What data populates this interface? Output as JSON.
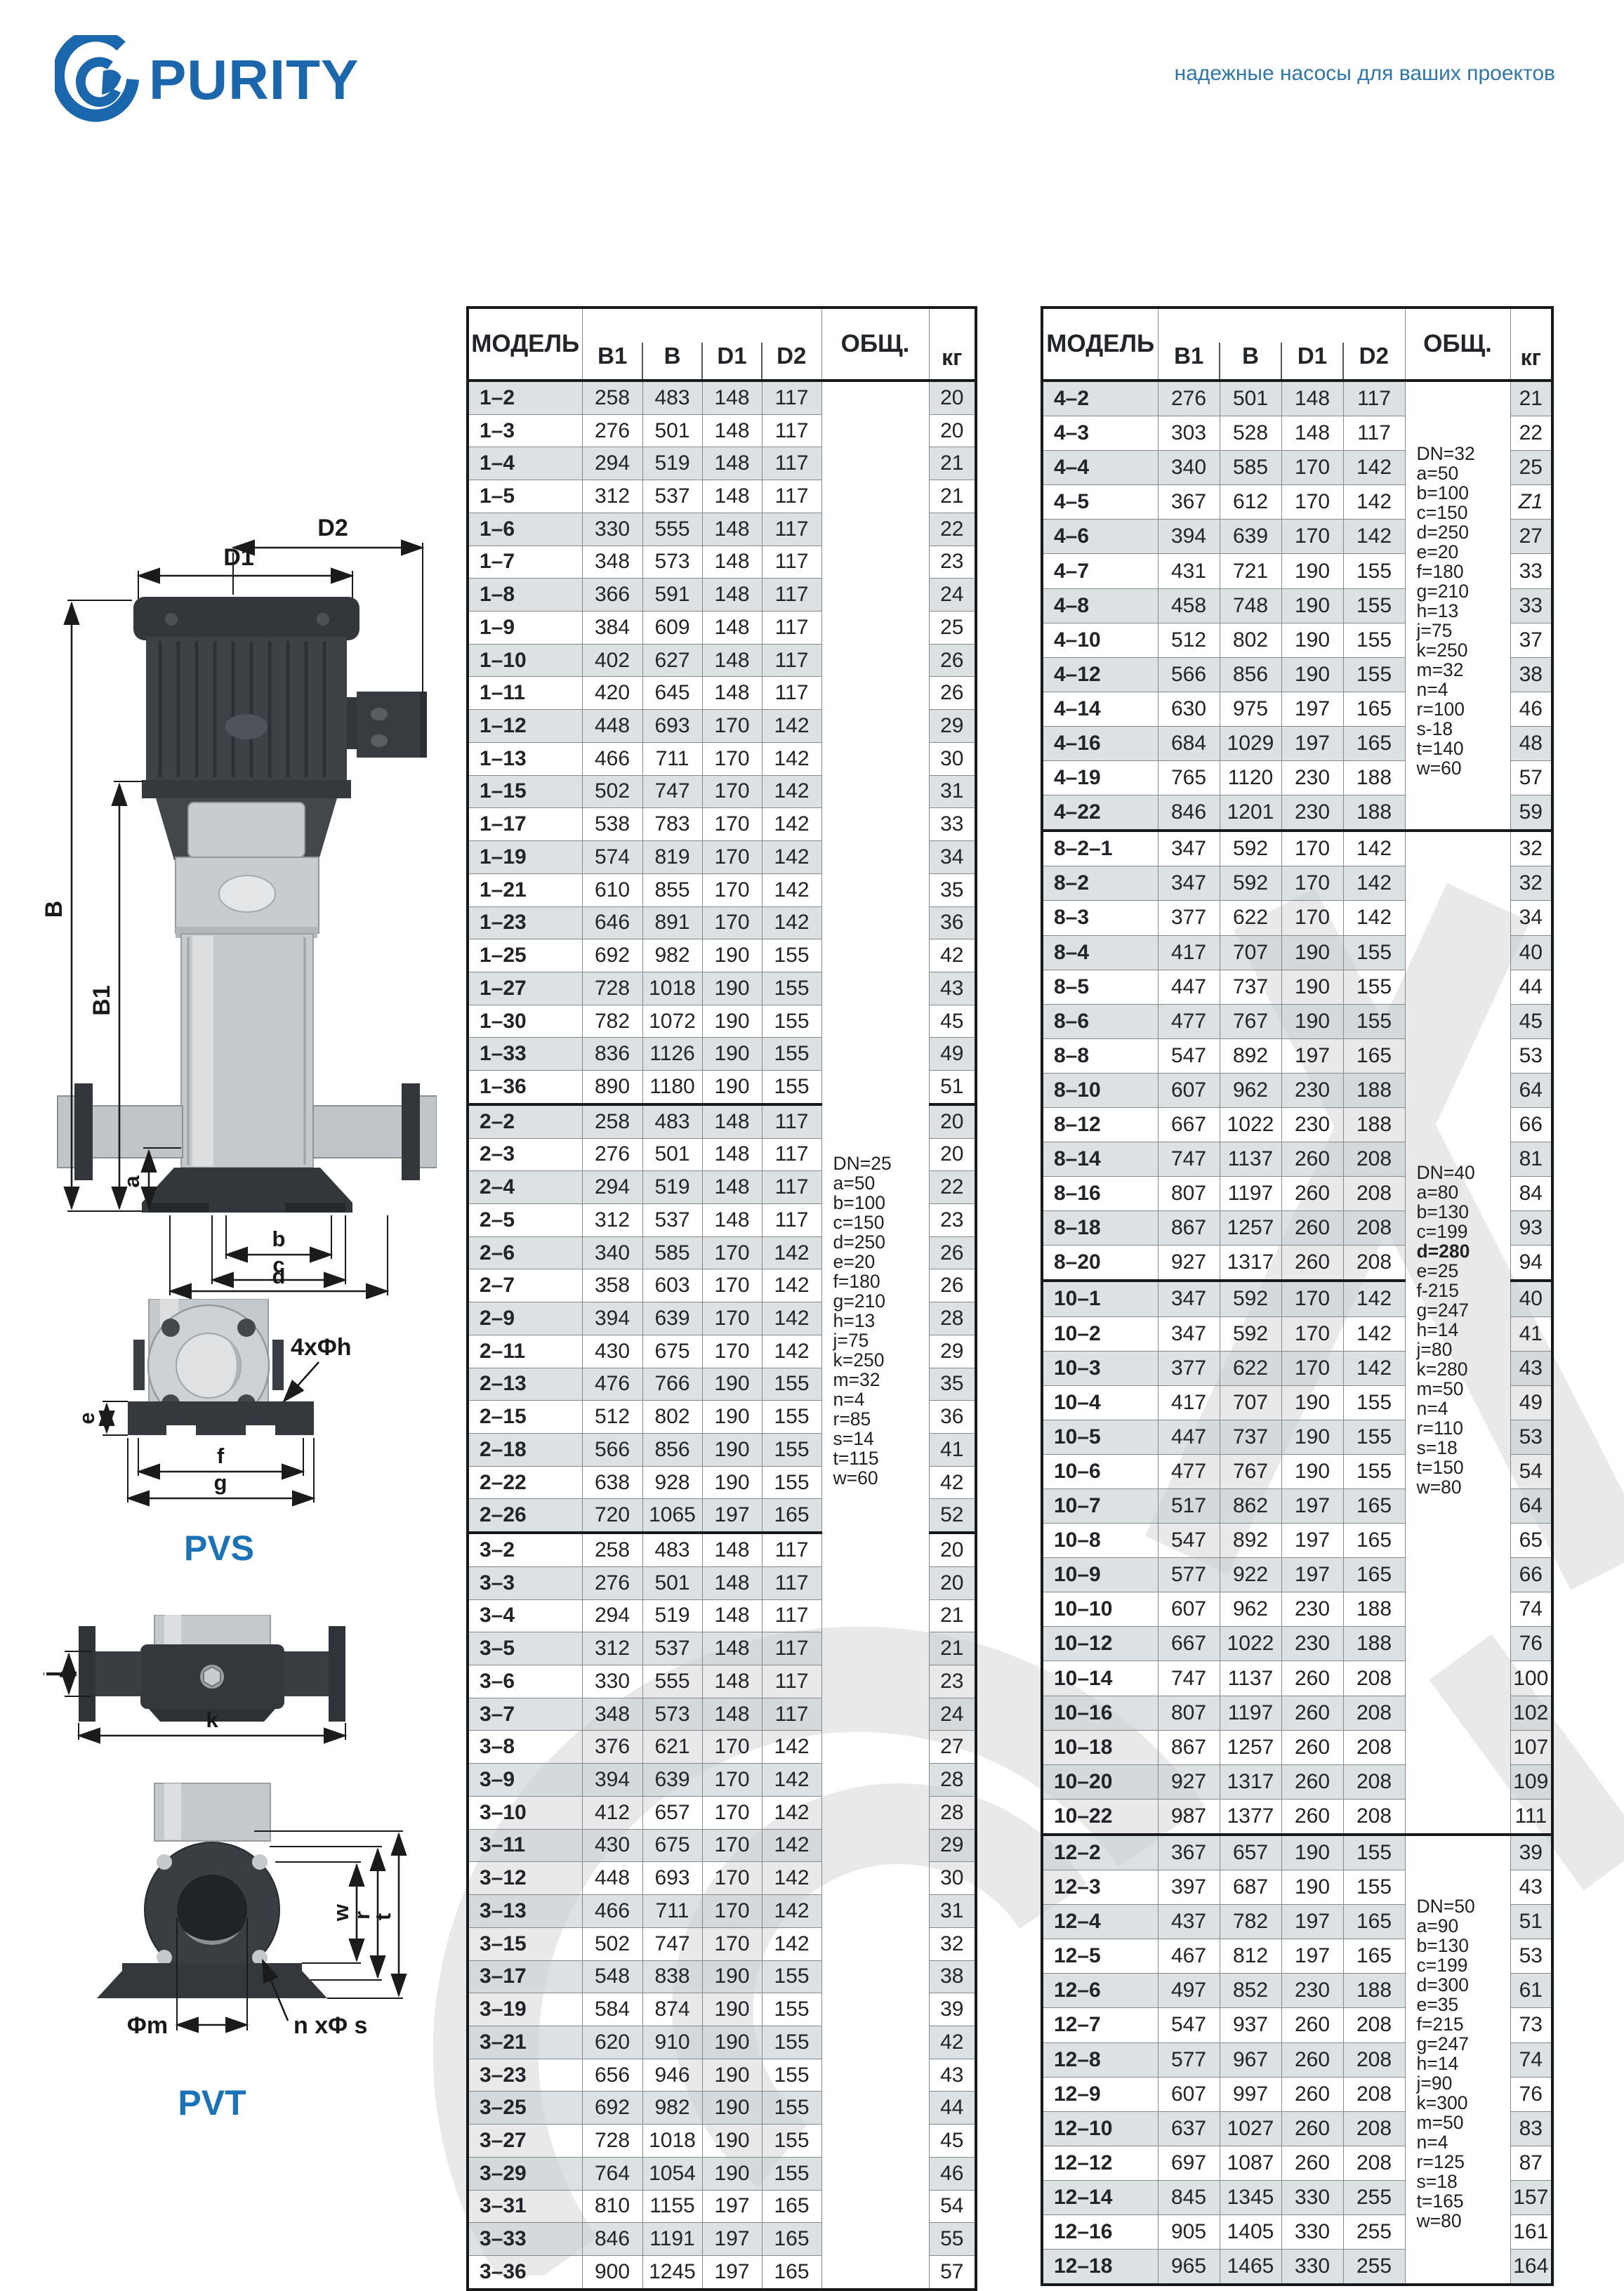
{
  "page": {
    "brand": "PURITY",
    "tagline": "надежные насосы для ваших проектов"
  },
  "colors": {
    "brand_blue": "#1a67ae",
    "diagram_title_blue": "#1a72b8",
    "row_stripe": "#dfe3e6"
  },
  "diagrams": {
    "main": {
      "d1": "D1",
      "d2": "D2",
      "b_total": "B",
      "b1": "B1",
      "a": "a",
      "b": "b",
      "c": "c",
      "d": "d"
    },
    "pvs": {
      "title": "PVS",
      "holes": "4xΦh",
      "e": "e",
      "f": "f",
      "g": "g"
    },
    "pvt": {
      "title": "PVT",
      "j": "j",
      "k": "k",
      "phi_m": "Φm",
      "n_phi_s": "n xΦ s",
      "w": "w",
      "r": "r",
      "t": "t"
    }
  },
  "table_headers": {
    "model": "МОДЕЛЬ",
    "b1": "B1",
    "b": "B",
    "d1": "D1",
    "d2": "D2",
    "total": "ОБЩ.",
    "kg": "кг"
  },
  "left_table": {
    "groups": [
      {
        "rows": [
          [
            "1–2",
            258,
            483,
            148,
            117,
            20
          ],
          [
            "1–3",
            276,
            501,
            148,
            117,
            20
          ],
          [
            "1–4",
            294,
            519,
            148,
            117,
            21
          ],
          [
            "1–5",
            312,
            537,
            148,
            117,
            21
          ],
          [
            "1–6",
            330,
            555,
            148,
            117,
            22
          ],
          [
            "1–7",
            348,
            573,
            148,
            117,
            23
          ],
          [
            "1–8",
            366,
            591,
            148,
            117,
            24
          ],
          [
            "1–9",
            384,
            609,
            148,
            117,
            25
          ],
          [
            "1–10",
            402,
            627,
            148,
            117,
            26
          ],
          [
            "1–11",
            420,
            645,
            148,
            117,
            26
          ],
          [
            "1–12",
            448,
            693,
            170,
            142,
            29
          ],
          [
            "1–13",
            466,
            711,
            170,
            142,
            30
          ],
          [
            "1–15",
            502,
            747,
            170,
            142,
            31
          ],
          [
            "1–17",
            538,
            783,
            170,
            142,
            33
          ],
          [
            "1–19",
            574,
            819,
            170,
            142,
            34
          ],
          [
            "1–21",
            610,
            855,
            170,
            142,
            35
          ],
          [
            "1–23",
            646,
            891,
            170,
            142,
            36
          ],
          [
            "1–25",
            692,
            982,
            190,
            155,
            42
          ],
          [
            "1–27",
            728,
            1018,
            190,
            155,
            43
          ],
          [
            "1–30",
            782,
            1072,
            190,
            155,
            45
          ],
          [
            "1–33",
            836,
            1126,
            190,
            155,
            49
          ],
          [
            "1–36",
            890,
            1180,
            190,
            155,
            51
          ]
        ]
      },
      {
        "rows": [
          [
            "2–2",
            258,
            483,
            148,
            117,
            20
          ],
          [
            "2–3",
            276,
            501,
            148,
            117,
            20
          ],
          [
            "2–4",
            294,
            519,
            148,
            117,
            22
          ],
          [
            "2–5",
            312,
            537,
            148,
            117,
            23
          ],
          [
            "2–6",
            340,
            585,
            170,
            142,
            26
          ],
          [
            "2–7",
            358,
            603,
            170,
            142,
            26
          ],
          [
            "2–9",
            394,
            639,
            170,
            142,
            28
          ],
          [
            "2–11",
            430,
            675,
            170,
            142,
            29
          ],
          [
            "2–13",
            476,
            766,
            190,
            155,
            35
          ],
          [
            "2–15",
            512,
            802,
            190,
            155,
            36
          ],
          [
            "2–18",
            566,
            856,
            190,
            155,
            41
          ],
          [
            "2–22",
            638,
            928,
            190,
            155,
            42
          ],
          [
            "2–26",
            720,
            1065,
            197,
            165,
            52
          ]
        ]
      },
      {
        "rows": [
          [
            "3–2",
            258,
            483,
            148,
            117,
            20
          ],
          [
            "3–3",
            276,
            501,
            148,
            117,
            20
          ],
          [
            "3–4",
            294,
            519,
            148,
            117,
            21
          ],
          [
            "3–5",
            312,
            537,
            148,
            117,
            21
          ],
          [
            "3–6",
            330,
            555,
            148,
            117,
            23
          ],
          [
            "3–7",
            348,
            573,
            148,
            117,
            24
          ],
          [
            "3–8",
            376,
            621,
            170,
            142,
            27
          ],
          [
            "3–9",
            394,
            639,
            170,
            142,
            28
          ],
          [
            "3–10",
            412,
            657,
            170,
            142,
            28
          ],
          [
            "3–11",
            430,
            675,
            170,
            142,
            29
          ],
          [
            "3–12",
            448,
            693,
            170,
            142,
            30
          ],
          [
            "3–13",
            466,
            711,
            170,
            142,
            31
          ],
          [
            "3–15",
            502,
            747,
            170,
            142,
            32
          ],
          [
            "3–17",
            548,
            838,
            190,
            155,
            38
          ],
          [
            "3–19",
            584,
            874,
            190,
            155,
            39
          ],
          [
            "3–21",
            620,
            910,
            190,
            155,
            42
          ],
          [
            "3–23",
            656,
            946,
            190,
            155,
            43
          ],
          [
            "3–25",
            692,
            982,
            190,
            155,
            44
          ],
          [
            "3–27",
            728,
            1018,
            190,
            155,
            45
          ],
          [
            "3–29",
            764,
            1054,
            190,
            155,
            46
          ],
          [
            "3–31",
            810,
            1155,
            197,
            165,
            54
          ],
          [
            "3–33",
            846,
            1191,
            197,
            165,
            55
          ],
          [
            "3–36",
            900,
            1245,
            197,
            165,
            57
          ]
        ]
      }
    ],
    "notes": [
      {
        "lines": [
          "DN=25",
          "a=50",
          "b=100",
          "c=150",
          "d=250",
          "e=20",
          "f=180",
          "g=210",
          "h=13",
          "j=75",
          "k=250",
          "m=32",
          "n=4",
          "r=85",
          "s=14",
          "t=115",
          "w=60"
        ]
      }
    ]
  },
  "right_table": {
    "groups": [
      {
        "rows": [
          [
            "4–2",
            276,
            501,
            148,
            117,
            21
          ],
          [
            "4–3",
            303,
            528,
            148,
            117,
            22
          ],
          [
            "4–4",
            340,
            585,
            170,
            142,
            25
          ],
          [
            "4–5",
            367,
            612,
            170,
            142,
            "Z1"
          ],
          [
            "4–6",
            394,
            639,
            170,
            142,
            27
          ],
          [
            "4–7",
            431,
            721,
            190,
            155,
            33
          ],
          [
            "4–8",
            458,
            748,
            190,
            155,
            33
          ],
          [
            "4–10",
            512,
            802,
            190,
            155,
            37
          ],
          [
            "4–12",
            566,
            856,
            190,
            155,
            38
          ],
          [
            "4–14",
            630,
            975,
            197,
            165,
            46
          ],
          [
            "4–16",
            684,
            1029,
            197,
            165,
            48
          ],
          [
            "4–19",
            765,
            1120,
            230,
            188,
            57
          ],
          [
            "4–22",
            846,
            1201,
            230,
            188,
            59
          ]
        ]
      },
      {
        "rows": [
          [
            "8–2–1",
            347,
            592,
            170,
            142,
            32
          ],
          [
            "8–2",
            347,
            592,
            170,
            142,
            32
          ],
          [
            "8–3",
            377,
            622,
            170,
            142,
            34
          ],
          [
            "8–4",
            417,
            707,
            190,
            155,
            40
          ],
          [
            "8–5",
            447,
            737,
            190,
            155,
            44
          ],
          [
            "8–6",
            477,
            767,
            190,
            155,
            45
          ],
          [
            "8–8",
            547,
            892,
            197,
            165,
            53
          ],
          [
            "8–10",
            607,
            962,
            230,
            188,
            64
          ],
          [
            "8–12",
            667,
            1022,
            230,
            188,
            66
          ],
          [
            "8–14",
            747,
            1137,
            260,
            208,
            81
          ],
          [
            "8–16",
            807,
            1197,
            260,
            208,
            84
          ],
          [
            "8–18",
            867,
            1257,
            260,
            208,
            93
          ],
          [
            "8–20",
            927,
            1317,
            260,
            208,
            94
          ]
        ]
      },
      {
        "rows": [
          [
            "10–1",
            347,
            592,
            170,
            142,
            40
          ],
          [
            "10–2",
            347,
            592,
            170,
            142,
            41
          ],
          [
            "10–3",
            377,
            622,
            170,
            142,
            43
          ],
          [
            "10–4",
            417,
            707,
            190,
            155,
            49
          ],
          [
            "10–5",
            447,
            737,
            190,
            155,
            53
          ],
          [
            "10–6",
            477,
            767,
            190,
            155,
            54
          ],
          [
            "10–7",
            517,
            862,
            197,
            165,
            64
          ],
          [
            "10–8",
            547,
            892,
            197,
            165,
            65
          ],
          [
            "10–9",
            577,
            922,
            197,
            165,
            66
          ],
          [
            "10–10",
            607,
            962,
            230,
            188,
            74
          ],
          [
            "10–12",
            667,
            1022,
            230,
            188,
            76
          ],
          [
            "10–14",
            747,
            1137,
            260,
            208,
            100
          ],
          [
            "10–16",
            807,
            1197,
            260,
            208,
            102
          ],
          [
            "10–18",
            867,
            1257,
            260,
            208,
            107
          ],
          [
            "10–20",
            927,
            1317,
            260,
            208,
            109
          ],
          [
            "10–22",
            987,
            1377,
            260,
            208,
            111
          ]
        ]
      },
      {
        "rows": [
          [
            "12–2",
            367,
            657,
            190,
            155,
            39
          ],
          [
            "12–3",
            397,
            687,
            190,
            155,
            43
          ],
          [
            "12–4",
            437,
            782,
            197,
            165,
            51
          ],
          [
            "12–5",
            467,
            812,
            197,
            165,
            53
          ],
          [
            "12–6",
            497,
            852,
            230,
            188,
            61
          ],
          [
            "12–7",
            547,
            937,
            260,
            208,
            73
          ],
          [
            "12–8",
            577,
            967,
            260,
            208,
            74
          ],
          [
            "12–9",
            607,
            997,
            260,
            208,
            76
          ],
          [
            "12–10",
            637,
            1027,
            260,
            208,
            83
          ],
          [
            "12–12",
            697,
            1087,
            260,
            208,
            87
          ],
          [
            "12–14",
            845,
            1345,
            330,
            255,
            157
          ],
          [
            "12–16",
            905,
            1405,
            330,
            255,
            161
          ],
          [
            "12–18",
            965,
            1465,
            330,
            255,
            164
          ]
        ]
      }
    ],
    "notes": [
      {
        "lines": [
          "DN=32",
          "a=50",
          "b=100",
          "c=150",
          "d=250",
          "e=20",
          "f=180",
          "g=210",
          "h=13",
          "j=75",
          "k=250",
          "m=32",
          "n=4",
          "r=100",
          "s-18",
          "t=140",
          "w=60"
        ]
      },
      {
        "lines": [
          "DN=40",
          "a=80",
          "b=130",
          "c=199",
          "d=280",
          "e=25",
          "f-215",
          "g=247",
          "h=14",
          "j=80",
          "k=280",
          "m=50",
          "n=4",
          "r=110",
          "s=18",
          "t=150",
          "w=80"
        ],
        "bold": [
          "d=280"
        ]
      },
      {
        "lines": [
          "DN=50",
          "a=90",
          "b=130",
          "c=199",
          "d=300",
          "e=35",
          "f=215",
          "g=247",
          "h=14",
          "j=90",
          "k=300",
          "m=50",
          "n=4",
          "r=125",
          "s=18",
          "t=165",
          "w=80"
        ]
      }
    ]
  }
}
